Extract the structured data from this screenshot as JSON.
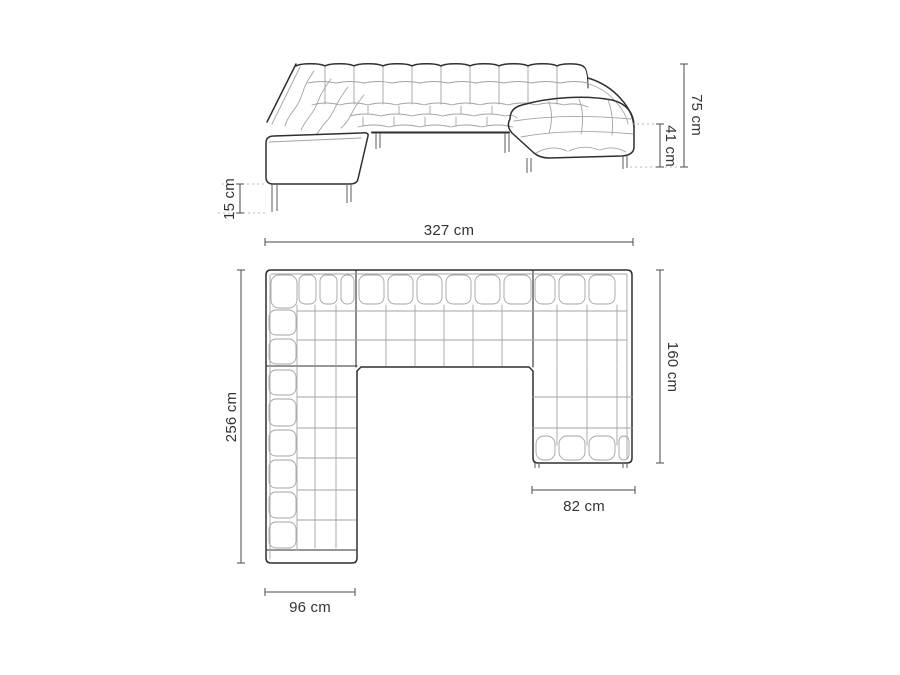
{
  "diagram": {
    "type": "sofa-dimension-diagram",
    "colors": {
      "background": "#ffffff",
      "outline": "#2f2f2f",
      "quilt_lines": "#a3a3a3",
      "dimension_lines": "#4a4a4a",
      "dotted_reference": "#b8b8b8",
      "label_text": "#333333"
    },
    "front_view": {
      "dims": {
        "total_height": "75 cm",
        "seat_height": "41 cm",
        "leg_height": "15 cm"
      }
    },
    "plan_view": {
      "dims": {
        "total_width": "327 cm",
        "total_depth": "256 cm",
        "chaise_length": "160 cm",
        "chaise_width": "82 cm",
        "arm_section_width": "96 cm"
      }
    }
  }
}
